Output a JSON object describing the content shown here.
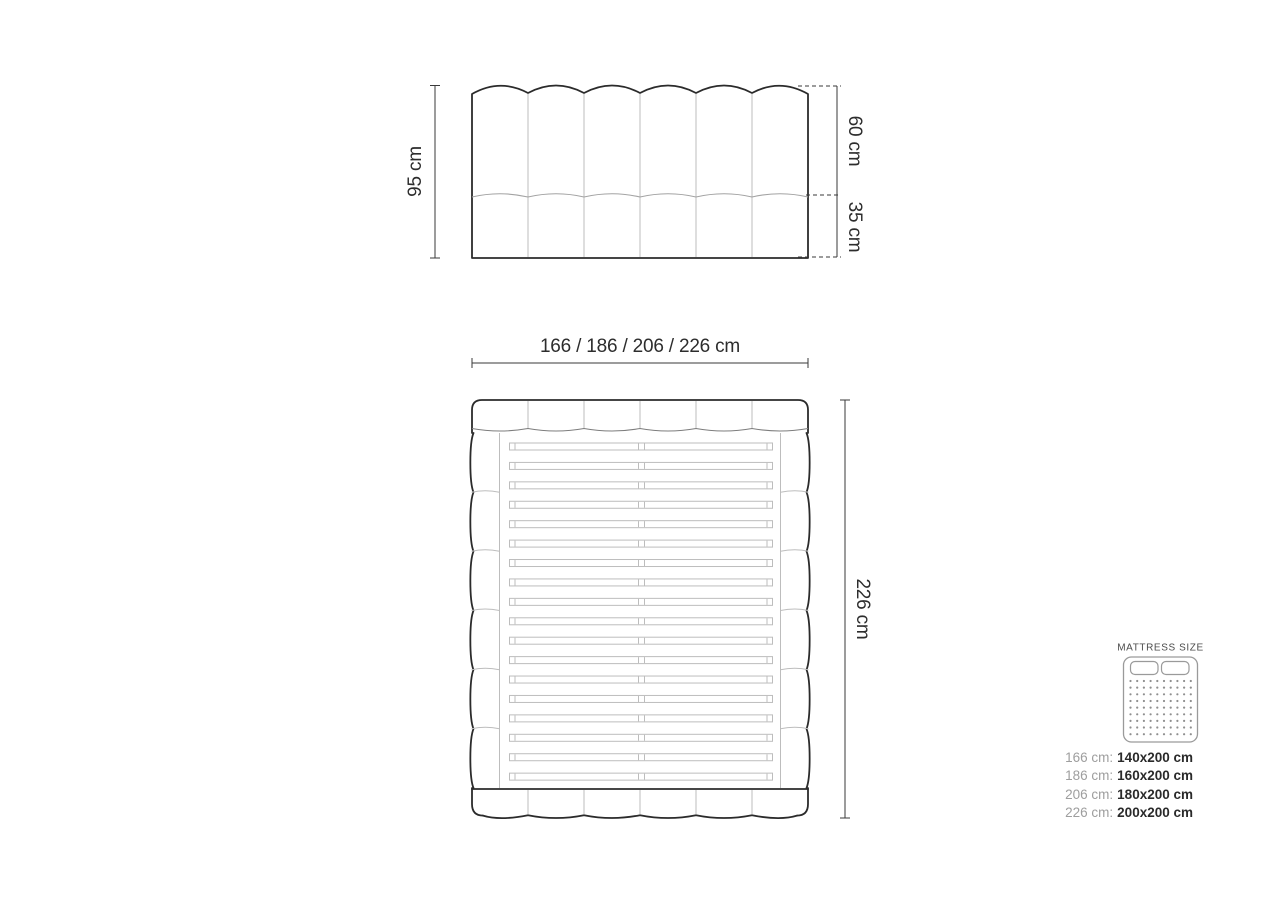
{
  "page": {
    "background": "#ffffff",
    "width": 1280,
    "height": 905
  },
  "front_view": {
    "height_label": "95 cm",
    "upper_label": "60 cm",
    "lower_label": "35 cm",
    "channel_count": 6
  },
  "top_view": {
    "width_label": "166 / 186 / 206 / 226 cm",
    "length_label": "226 cm",
    "channel_count": 6,
    "slat_count": 18,
    "side_bump_count": 6
  },
  "legend": {
    "title": "MATTRESS SIZE",
    "icon": {
      "name": "mattress-top-view-icon",
      "pillow_count": 2,
      "dot_rows": 9,
      "dot_cols": 10
    },
    "rows": [
      {
        "size": "166 cm:",
        "mattress": "140x200 cm"
      },
      {
        "size": "186 cm:",
        "mattress": "160x200 cm"
      },
      {
        "size": "206 cm:",
        "mattress": "180x200 cm"
      },
      {
        "size": "226 cm:",
        "mattress": "200x200 cm"
      }
    ]
  },
  "colors": {
    "outline": "#2b2b2b",
    "light_line": "#bdbdbd",
    "mid_line": "#7d7d7d",
    "dimension": "#3a3a3a",
    "label_text": "#2d2d2d",
    "muted_text": "#9e9e9e",
    "legend_title": "#4c4c4c"
  }
}
